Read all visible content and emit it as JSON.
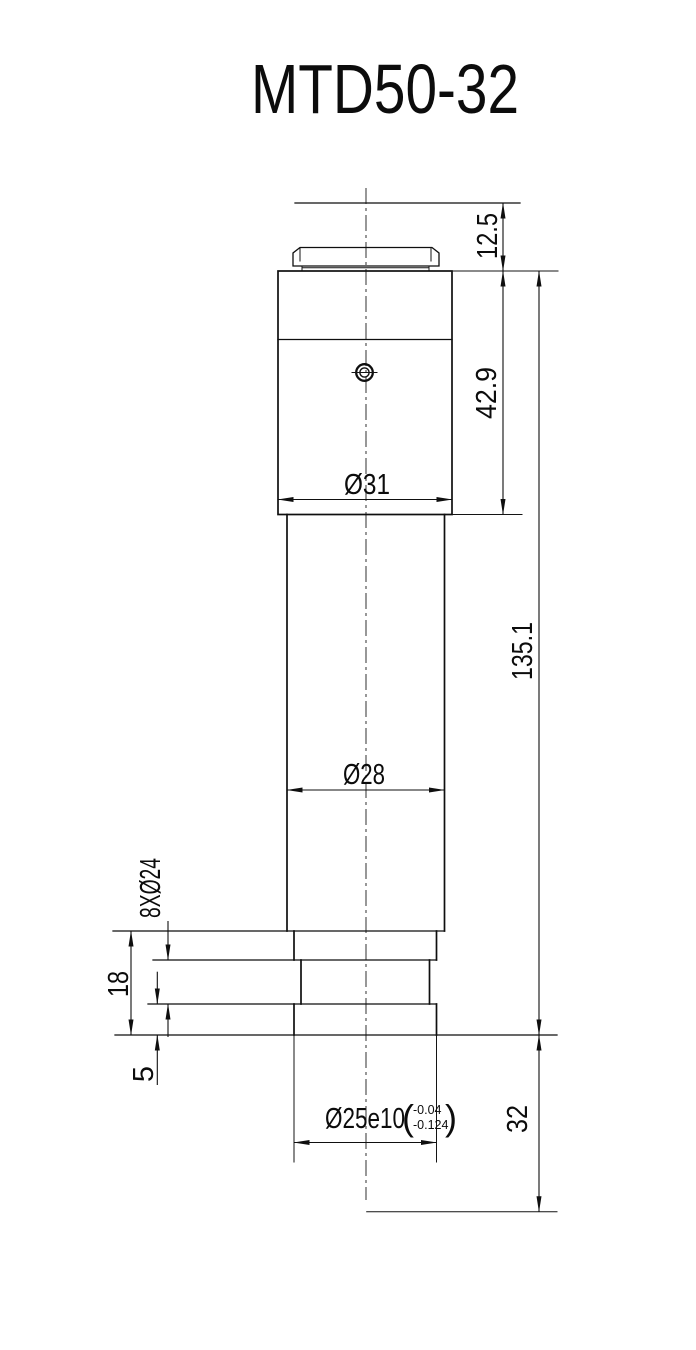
{
  "title": "MTD50-32",
  "drawing": {
    "dims": {
      "cap_offset": "12.5",
      "head_height": "42.9",
      "head_dia": "Ø31",
      "tube_dia": "Ø28",
      "body_length": "135.1",
      "flange_callout": "8XØ24",
      "flange_height": "18",
      "base_plate_height": "5",
      "spigot_dia": "Ø25e10",
      "tol_open": "(",
      "tol_upper": "-0.04",
      "tol_lower": "-0.124",
      "tol_close": ")",
      "insert_length": "32"
    }
  }
}
